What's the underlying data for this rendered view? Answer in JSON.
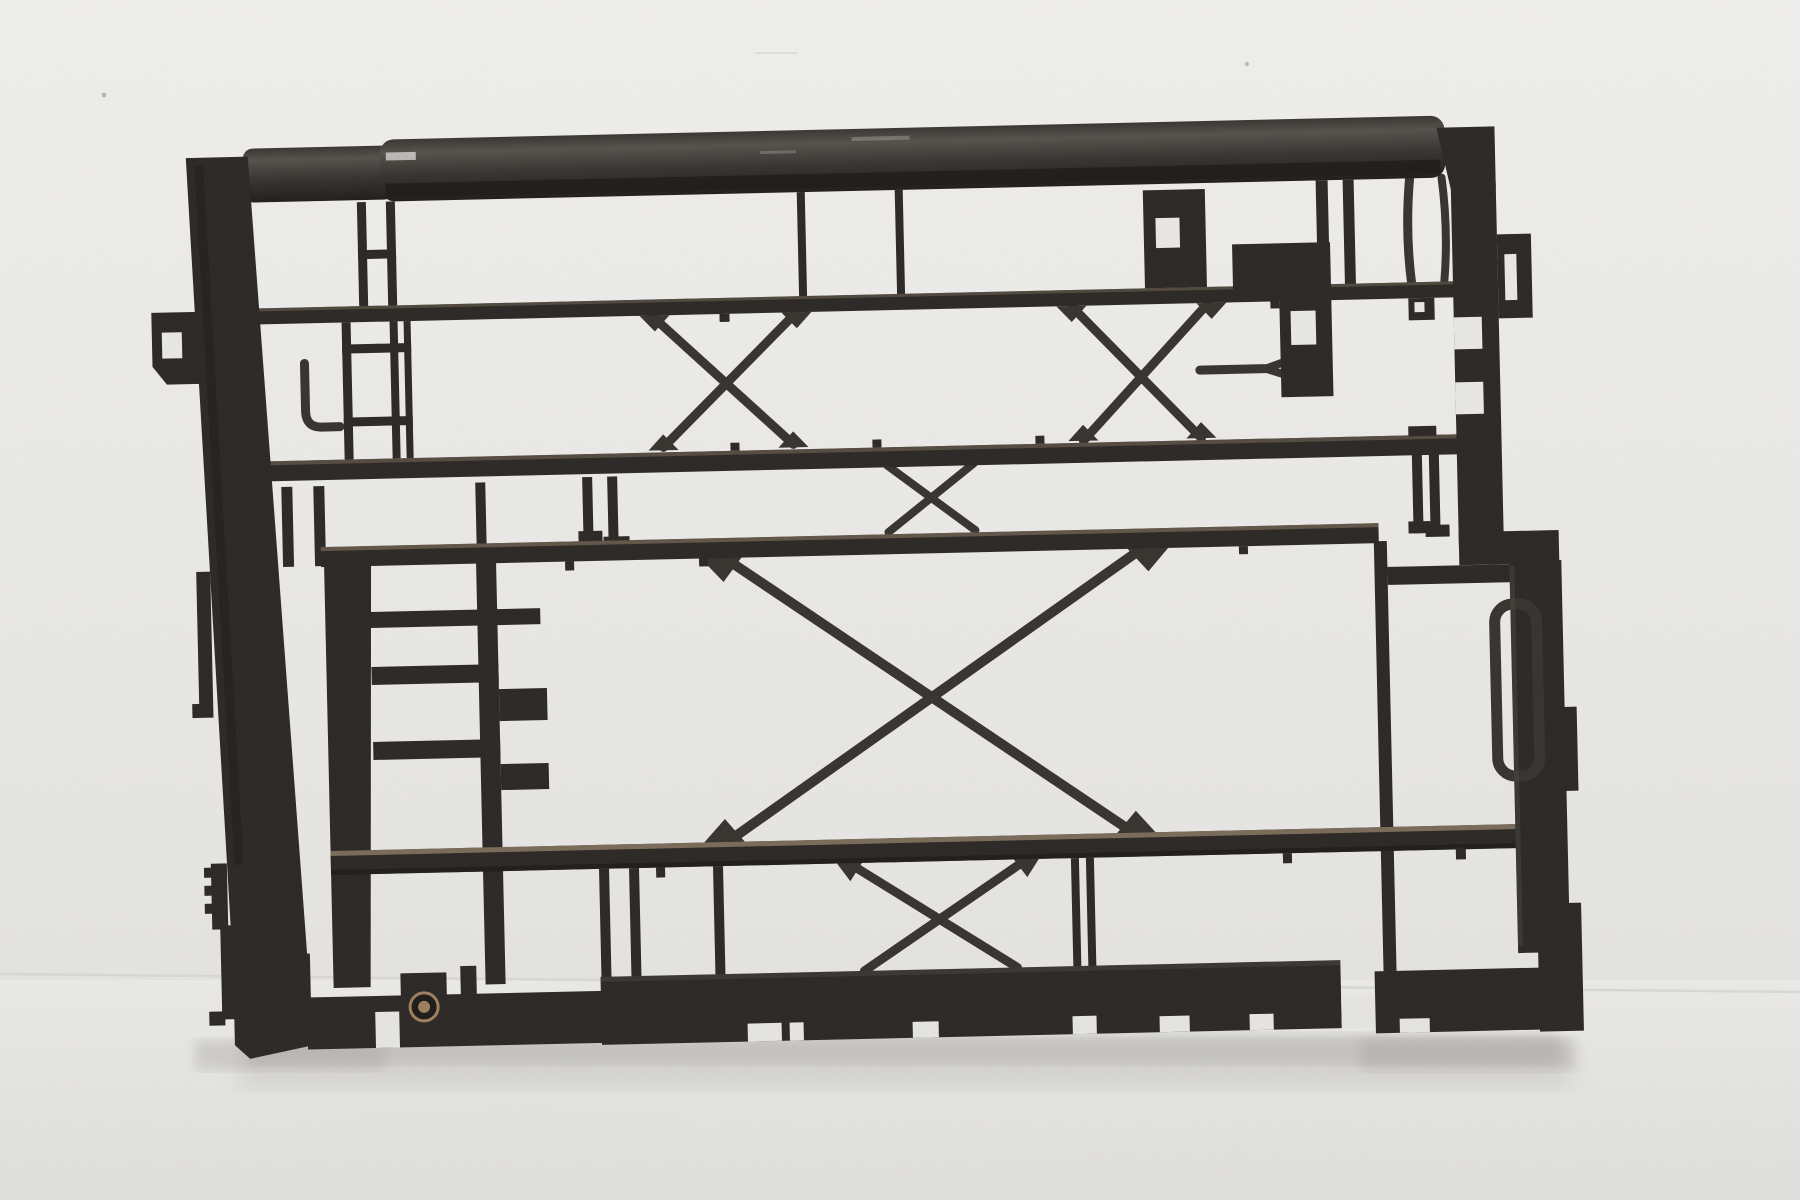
{
  "image": {
    "kind": "product photograph",
    "subject": "Black plastic radiator support frame",
    "description": "Used molded black plastic radiator / fan-shroud support frame, photographed slightly tilted against a light gray studio wall and floor with a soft contact shadow",
    "aria_label": "Photograph of a black plastic automotive radiator support frame on a light gray background"
  },
  "scene": {
    "tilt_deg": -1.3,
    "wall_floor_seam_y": 983,
    "lighting": "soft diffuse studio light"
  },
  "part": {
    "top_tube": "thick rounded top crossbar",
    "rails": [
      "upper tie rail",
      "second rail",
      "mid rail",
      "lower rail"
    ],
    "x_braces": [
      "upper left X",
      "upper right X",
      "small middle X",
      "large central X",
      "lower X"
    ],
    "ladder_columns": 2,
    "bottom_edge_notches": 9,
    "mounting_boss_holes": 1,
    "hook_slots": 1,
    "material": "molded black plastic with dusty tan wear on rail edges"
  },
  "colors": {
    "wall_top": "#efeeec",
    "wall_mid": "#e8e7e5",
    "wall_bottom": "#e4e3e1",
    "floor_top": "#eae9e7",
    "floor_mid": "#e5e4e2",
    "floor_bottom": "#dfdedc",
    "seam": "#d6d5d3",
    "vignette": "#c6c4c1",
    "shadow": "#a8a5a1",
    "plastic": "#2b2724",
    "plastic_dark": "#1d1a18",
    "plastic_strut": "#37322d",
    "tube_hi": "#55504b",
    "tube_mid": "#383430",
    "tube_dark": "#1f1c1a",
    "sheen": "#5a554f",
    "dust": "#8d7c65",
    "dust_soft": "#6e6254",
    "hole_tan": "#9c7f5d",
    "glint": "#d6d4d1",
    "speck": "#b9b7b4"
  }
}
